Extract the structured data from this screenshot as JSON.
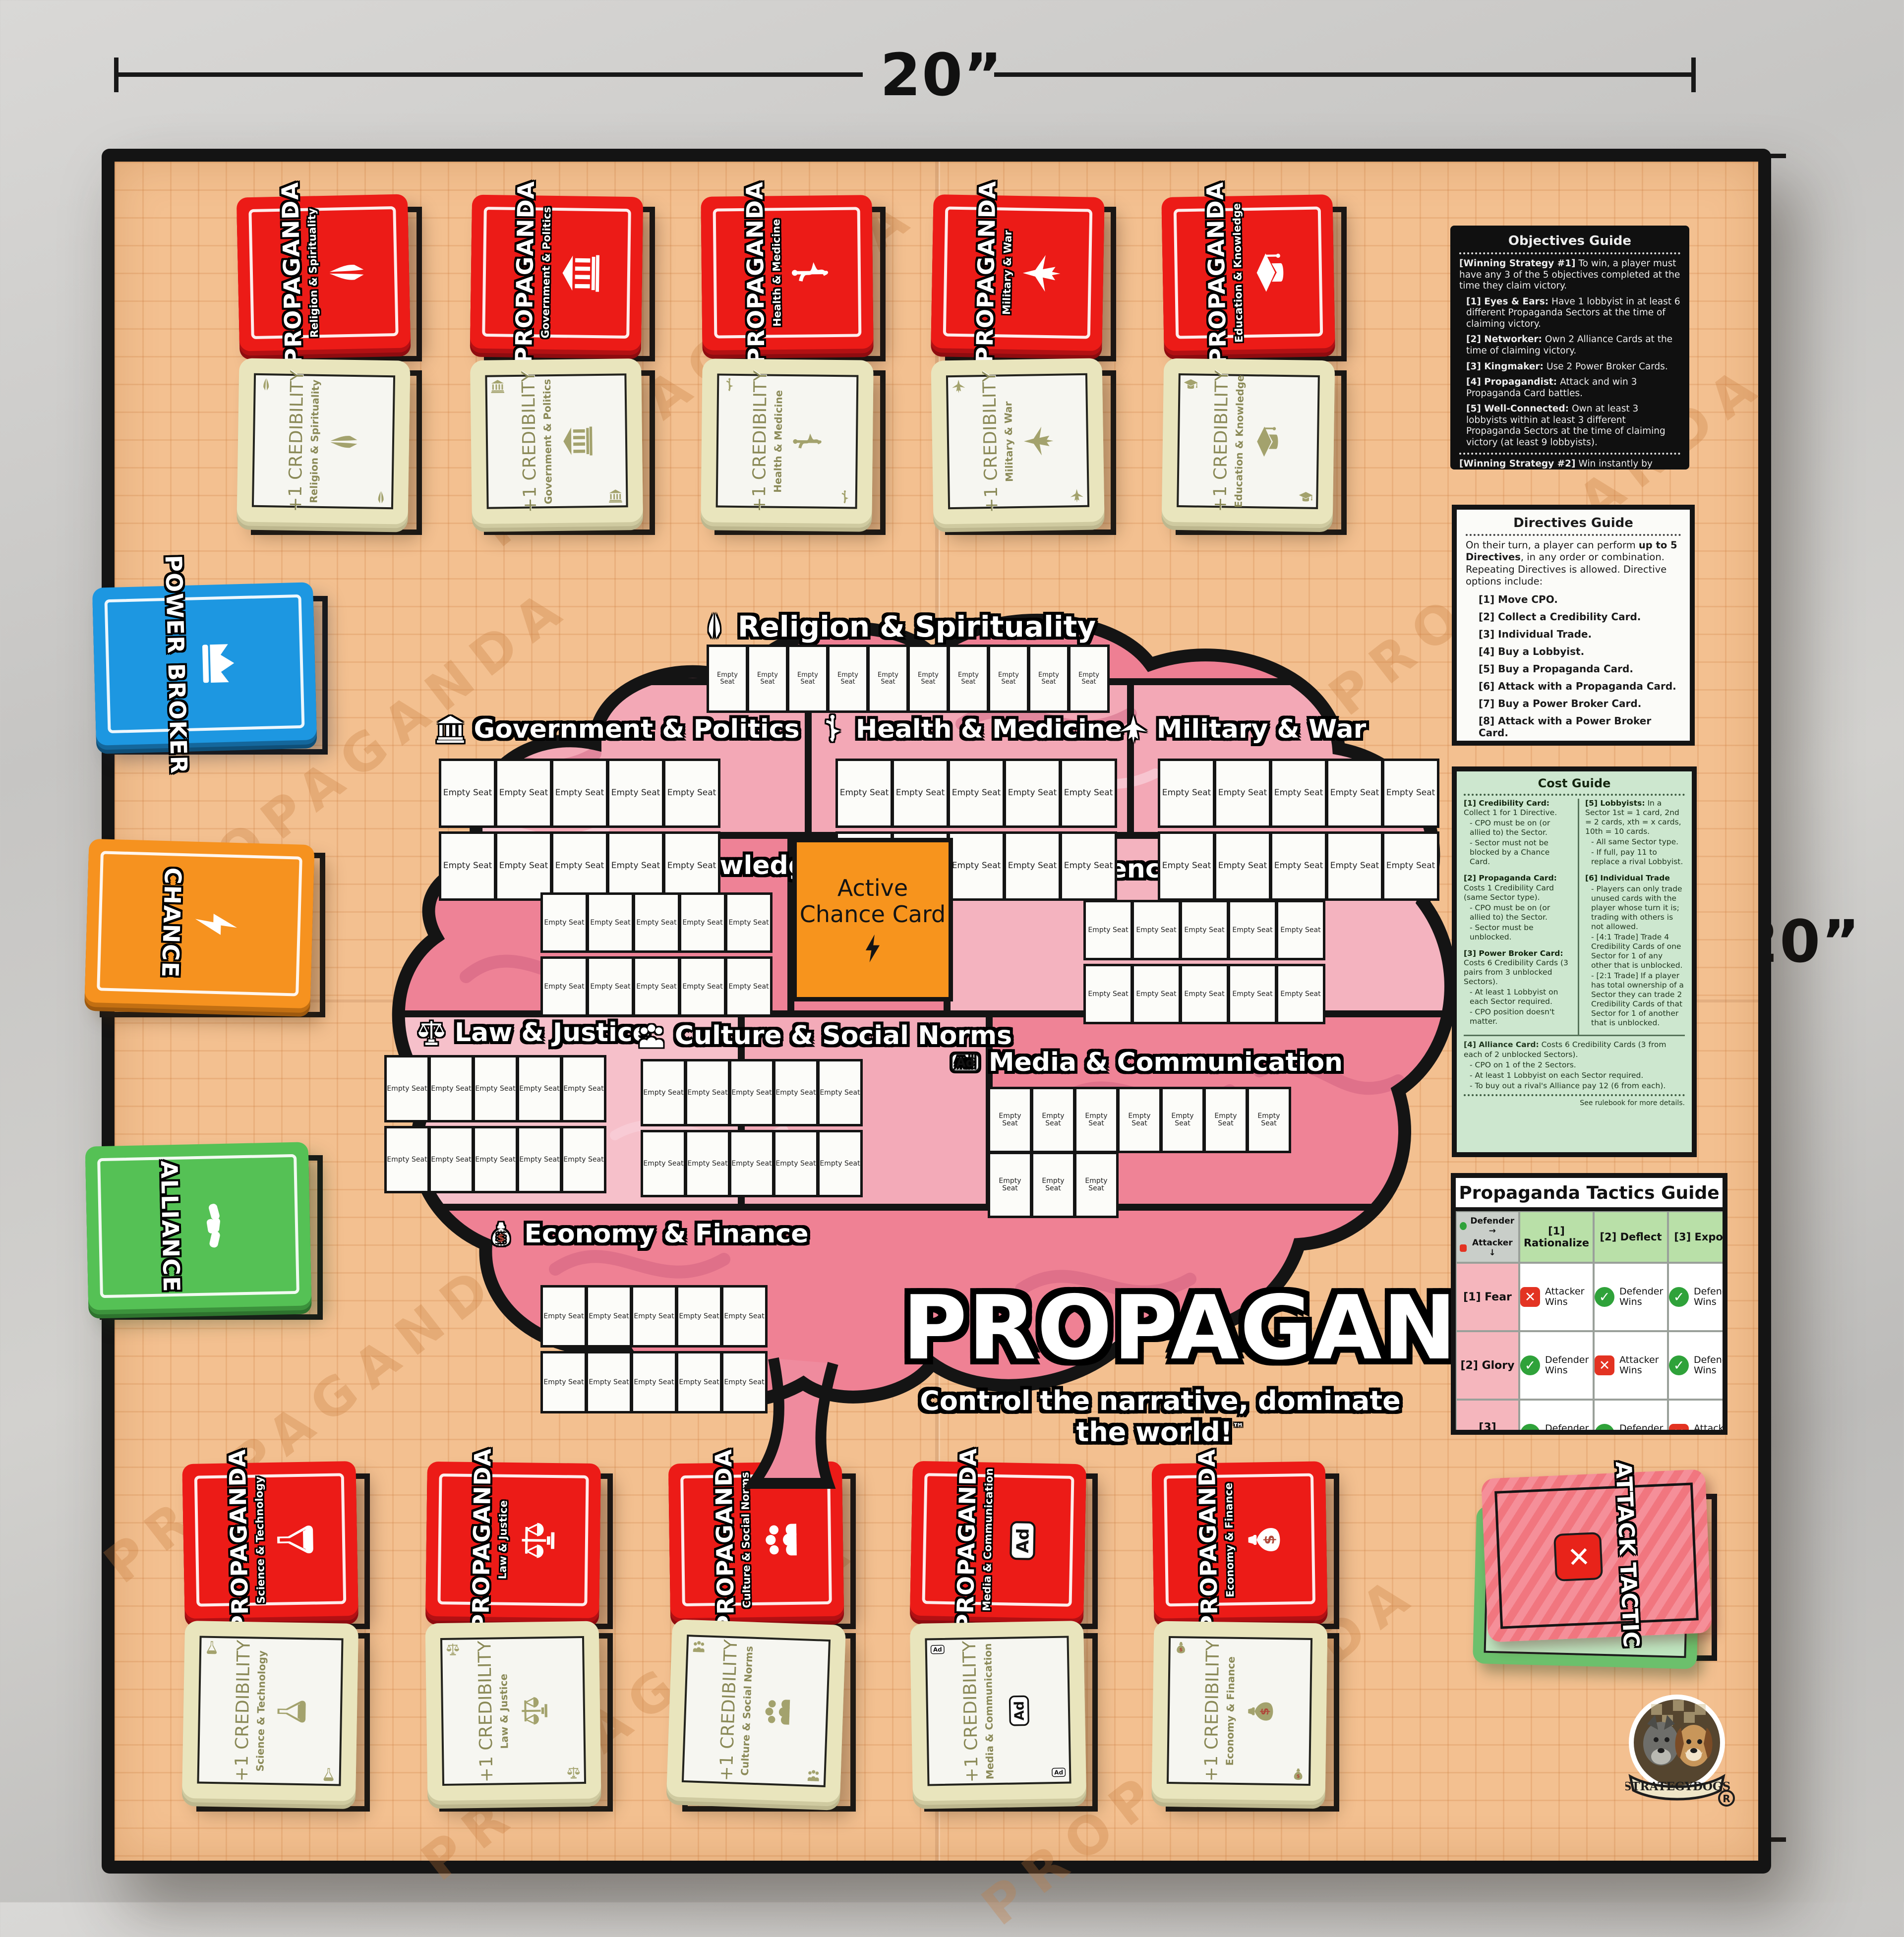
{
  "dimensions": {
    "width_label": "20”",
    "height_label": "20”"
  },
  "board": {
    "empty_seat_label": "Empty Seat",
    "active_chance_card": "Active Chance Card",
    "watermark": "PROPAGANDA"
  },
  "logo": {
    "title": "PROPAGANDA",
    "registered": "®",
    "tagline": "Control the narrative, dominate the world!",
    "trademark": "™"
  },
  "publisher": {
    "name": "STRATEGYDOGS",
    "registered": "®"
  },
  "sectors": [
    {
      "name": "Religion & Spirituality",
      "icon": "pray"
    },
    {
      "name": "Government & Politics",
      "icon": "bank"
    },
    {
      "name": "Health & Medicine",
      "icon": "medical"
    },
    {
      "name": "Military & War",
      "icon": "jet"
    },
    {
      "name": "Education & Knowledge",
      "icon": "grad"
    },
    {
      "name": "Science & Technology",
      "icon": "flask"
    },
    {
      "name": "Law & Justice",
      "icon": "scales"
    },
    {
      "name": "Culture & Social Norms",
      "icon": "people"
    },
    {
      "name": "Media & Communication",
      "icon": "ad"
    },
    {
      "name": "Economy & Finance",
      "icon": "money"
    }
  ],
  "decks": {
    "propaganda_label": "PROPAGANDA",
    "credibility_label": "+1 CREDIBILITY",
    "power_broker": "POWER BROKER",
    "chance": "CHANCE",
    "alliance": "ALLIANCE",
    "attack_tactic": "ATTACK TACTIC"
  },
  "objectives_guide": {
    "title": "Objectives Guide",
    "strategy1_head": "[Winning Strategy #1]",
    "strategy1_text": "To win, a player must have any 3 of the 5 objectives completed at the time they claim victory.",
    "items": [
      {
        "head": "[1] Eyes & Ears:",
        "text": "Have 1 lobbyist in at least 6 different Propaganda Sectors at the time of claiming victory."
      },
      {
        "head": "[2] Networker:",
        "text": "Own 2 Alliance Cards at the time of claiming victory."
      },
      {
        "head": "[3] Kingmaker:",
        "text": "Use 2 Power Broker Cards."
      },
      {
        "head": "[4] Propagandist:",
        "text": "Attack and win 3 Propaganda Card battles."
      },
      {
        "head": "[5] Well-Connected:",
        "text": "Own at least 3 lobbyists within at least 3 different Propaganda Sectors at the time of claiming victory (at least 9 lobbyists)."
      }
    ],
    "strategy2_head": "[Winning Strategy #2]",
    "strategy2_text": "Win instantly by being the first to place the majority of your Lobbyists on the board—51 (2 players), 34 (3), 26 (4), 21 (5), or 17 (6).",
    "footer": "See rulebook for more details."
  },
  "directives_guide": {
    "title": "Directives Guide",
    "intro_pre": "On their turn, a player can perform ",
    "intro_bold": "up to 5 Directives",
    "intro_post": ", in any order or combination. Repeating Directives is allowed. Directive options include:",
    "items": [
      "[1] Move CPO.",
      "[2] Collect a Credibility Card.",
      "[3] Individual Trade.",
      "[4] Buy a Lobbyist.",
      "[5] Buy a Propaganda Card.",
      "[6] Attack with a Propaganda Card.",
      "[7] Buy a Power Broker Card.",
      "[8] Attack with a Power Broker Card.",
      "[9] Buy an Alliance Card."
    ],
    "footer": "See rulebook for more details."
  },
  "cost_guide": {
    "title": "Cost Guide",
    "credibility": {
      "head": "[1] Credibility Card:",
      "text": "Collect 1 for 1 Directive.",
      "bullets": [
        "- CPO must be on (or allied to) the Sector.",
        "- Sector must not be blocked by a Chance Card."
      ]
    },
    "propaganda": {
      "head": "[2] Propaganda Card:",
      "text": "Costs 1 Credibility Card (same Sector type).",
      "bullets": [
        "- CPO must be on (or allied to) the Sector.",
        "- Sector must be unblocked."
      ]
    },
    "power_broker": {
      "head": "[3] Power Broker Card:",
      "text": "Costs 6 Credibility Cards (3 pairs from 3 unblocked Sectors).",
      "bullets": [
        "- At least 1 Lobbyist on each Sector required.",
        "- CPO position doesn't matter."
      ]
    },
    "lobbyists": {
      "head": "[5] Lobbyists:",
      "text": "In a Sector 1st = 1 card, 2nd = 2 cards, xth = x cards, 10th = 10 cards.",
      "bullets": [
        "- All same Sector type.",
        "- If full, pay 11 to replace a rival Lobbyist."
      ]
    },
    "individual_trade": {
      "head": "[6] Individual Trade",
      "text": "",
      "bullets": [
        "- Players can only trade unused cards with the player whose turn it is; trading with others is not allowed.",
        "- [4:1 Trade] Trade 4 Credibility Cards of one Sector for 1 of any other that is unblocked.",
        "- [2:1 Trade] If a player has total ownership of a Sector they can trade 2 Credibility Cards of that Sector for 1 of another that is unblocked."
      ]
    },
    "alliance": {
      "head": "[4] Alliance Card:",
      "text": "Costs 6 Credibility Cards (3 from each of 2 unblocked Sectors).",
      "bullets": [
        "- CPO on 1 of the 2 Sectors.",
        "- At least 1 Lobbyist on each Sector required.",
        "- To buy out a rival's Alliance pay 12 (6 from each)."
      ]
    },
    "footer": "See rulebook for more details."
  },
  "tactics_guide": {
    "title": "Propaganda Tactics Guide",
    "corner": {
      "defender": "Defender →",
      "attacker": "Attacker ↓"
    },
    "columns": [
      "[1] Rationalize",
      "[2] Deflect",
      "[3] Expose"
    ],
    "rows": [
      {
        "label": "[1] Fear",
        "cells": [
          {
            "text": "Attacker Wins",
            "icon": "x"
          },
          {
            "text": "Defender Wins",
            "icon": "check"
          },
          {
            "text": "Defender Wins",
            "icon": "check"
          }
        ]
      },
      {
        "label": "[2] Glory",
        "cells": [
          {
            "text": "Defender Wins",
            "icon": "check"
          },
          {
            "text": "Attacker Wins",
            "icon": "x"
          },
          {
            "text": "Defender Wins",
            "icon": "check"
          }
        ]
      },
      {
        "label": "[3] Disgust",
        "cells": [
          {
            "text": "Defender Wins",
            "icon": "check"
          },
          {
            "text": "Defender Wins",
            "icon": "check"
          },
          {
            "text": "Attacker Wins",
            "icon": "x"
          }
        ]
      }
    ]
  }
}
